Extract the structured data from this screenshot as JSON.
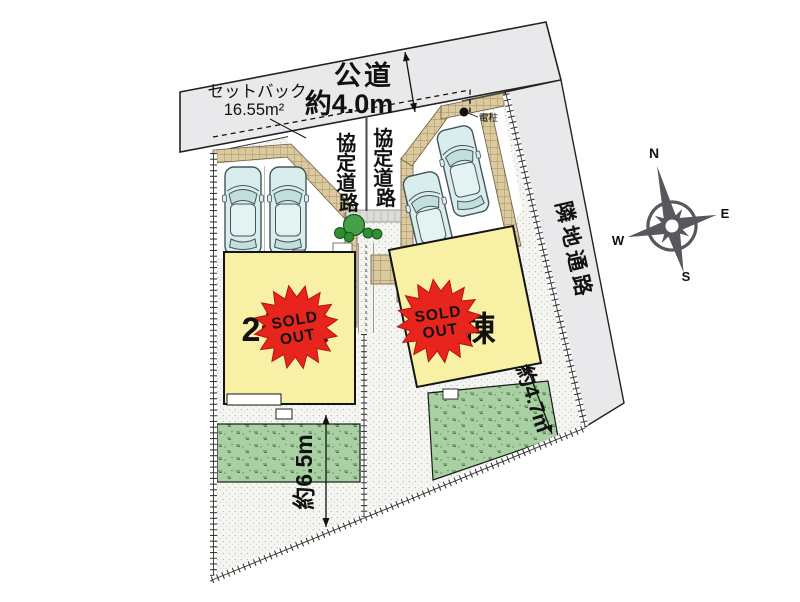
{
  "plan": {
    "road": {
      "name": "公道",
      "width": "約4.0m"
    },
    "setback": {
      "label": "セットバック",
      "area": "16.55m²"
    },
    "kyotei": [
      "協",
      "定",
      "道",
      "路"
    ],
    "pole": "電柱",
    "passage": "隣地通路",
    "buildings": {
      "left": {
        "label": "2号棟",
        "status": "SOLD OUT"
      },
      "right": {
        "label": "1号棟",
        "status": "SOLD OUT"
      }
    },
    "stamp": {
      "line1": "SOLD",
      "line2": "OUT"
    },
    "dims": {
      "left": "約6.5m",
      "right": "約4.7m"
    },
    "compass": {
      "n": "N",
      "e": "E",
      "s": "S",
      "w": "W"
    },
    "colors": {
      "road_fill": "#e9e9ec",
      "brick": "#dbc99f",
      "building": "#f7f0a5",
      "garden": "#a8d0a2",
      "car_body": "#d9edec",
      "stamp_red": "#e8251d",
      "compass_gray": "#58585c"
    }
  }
}
